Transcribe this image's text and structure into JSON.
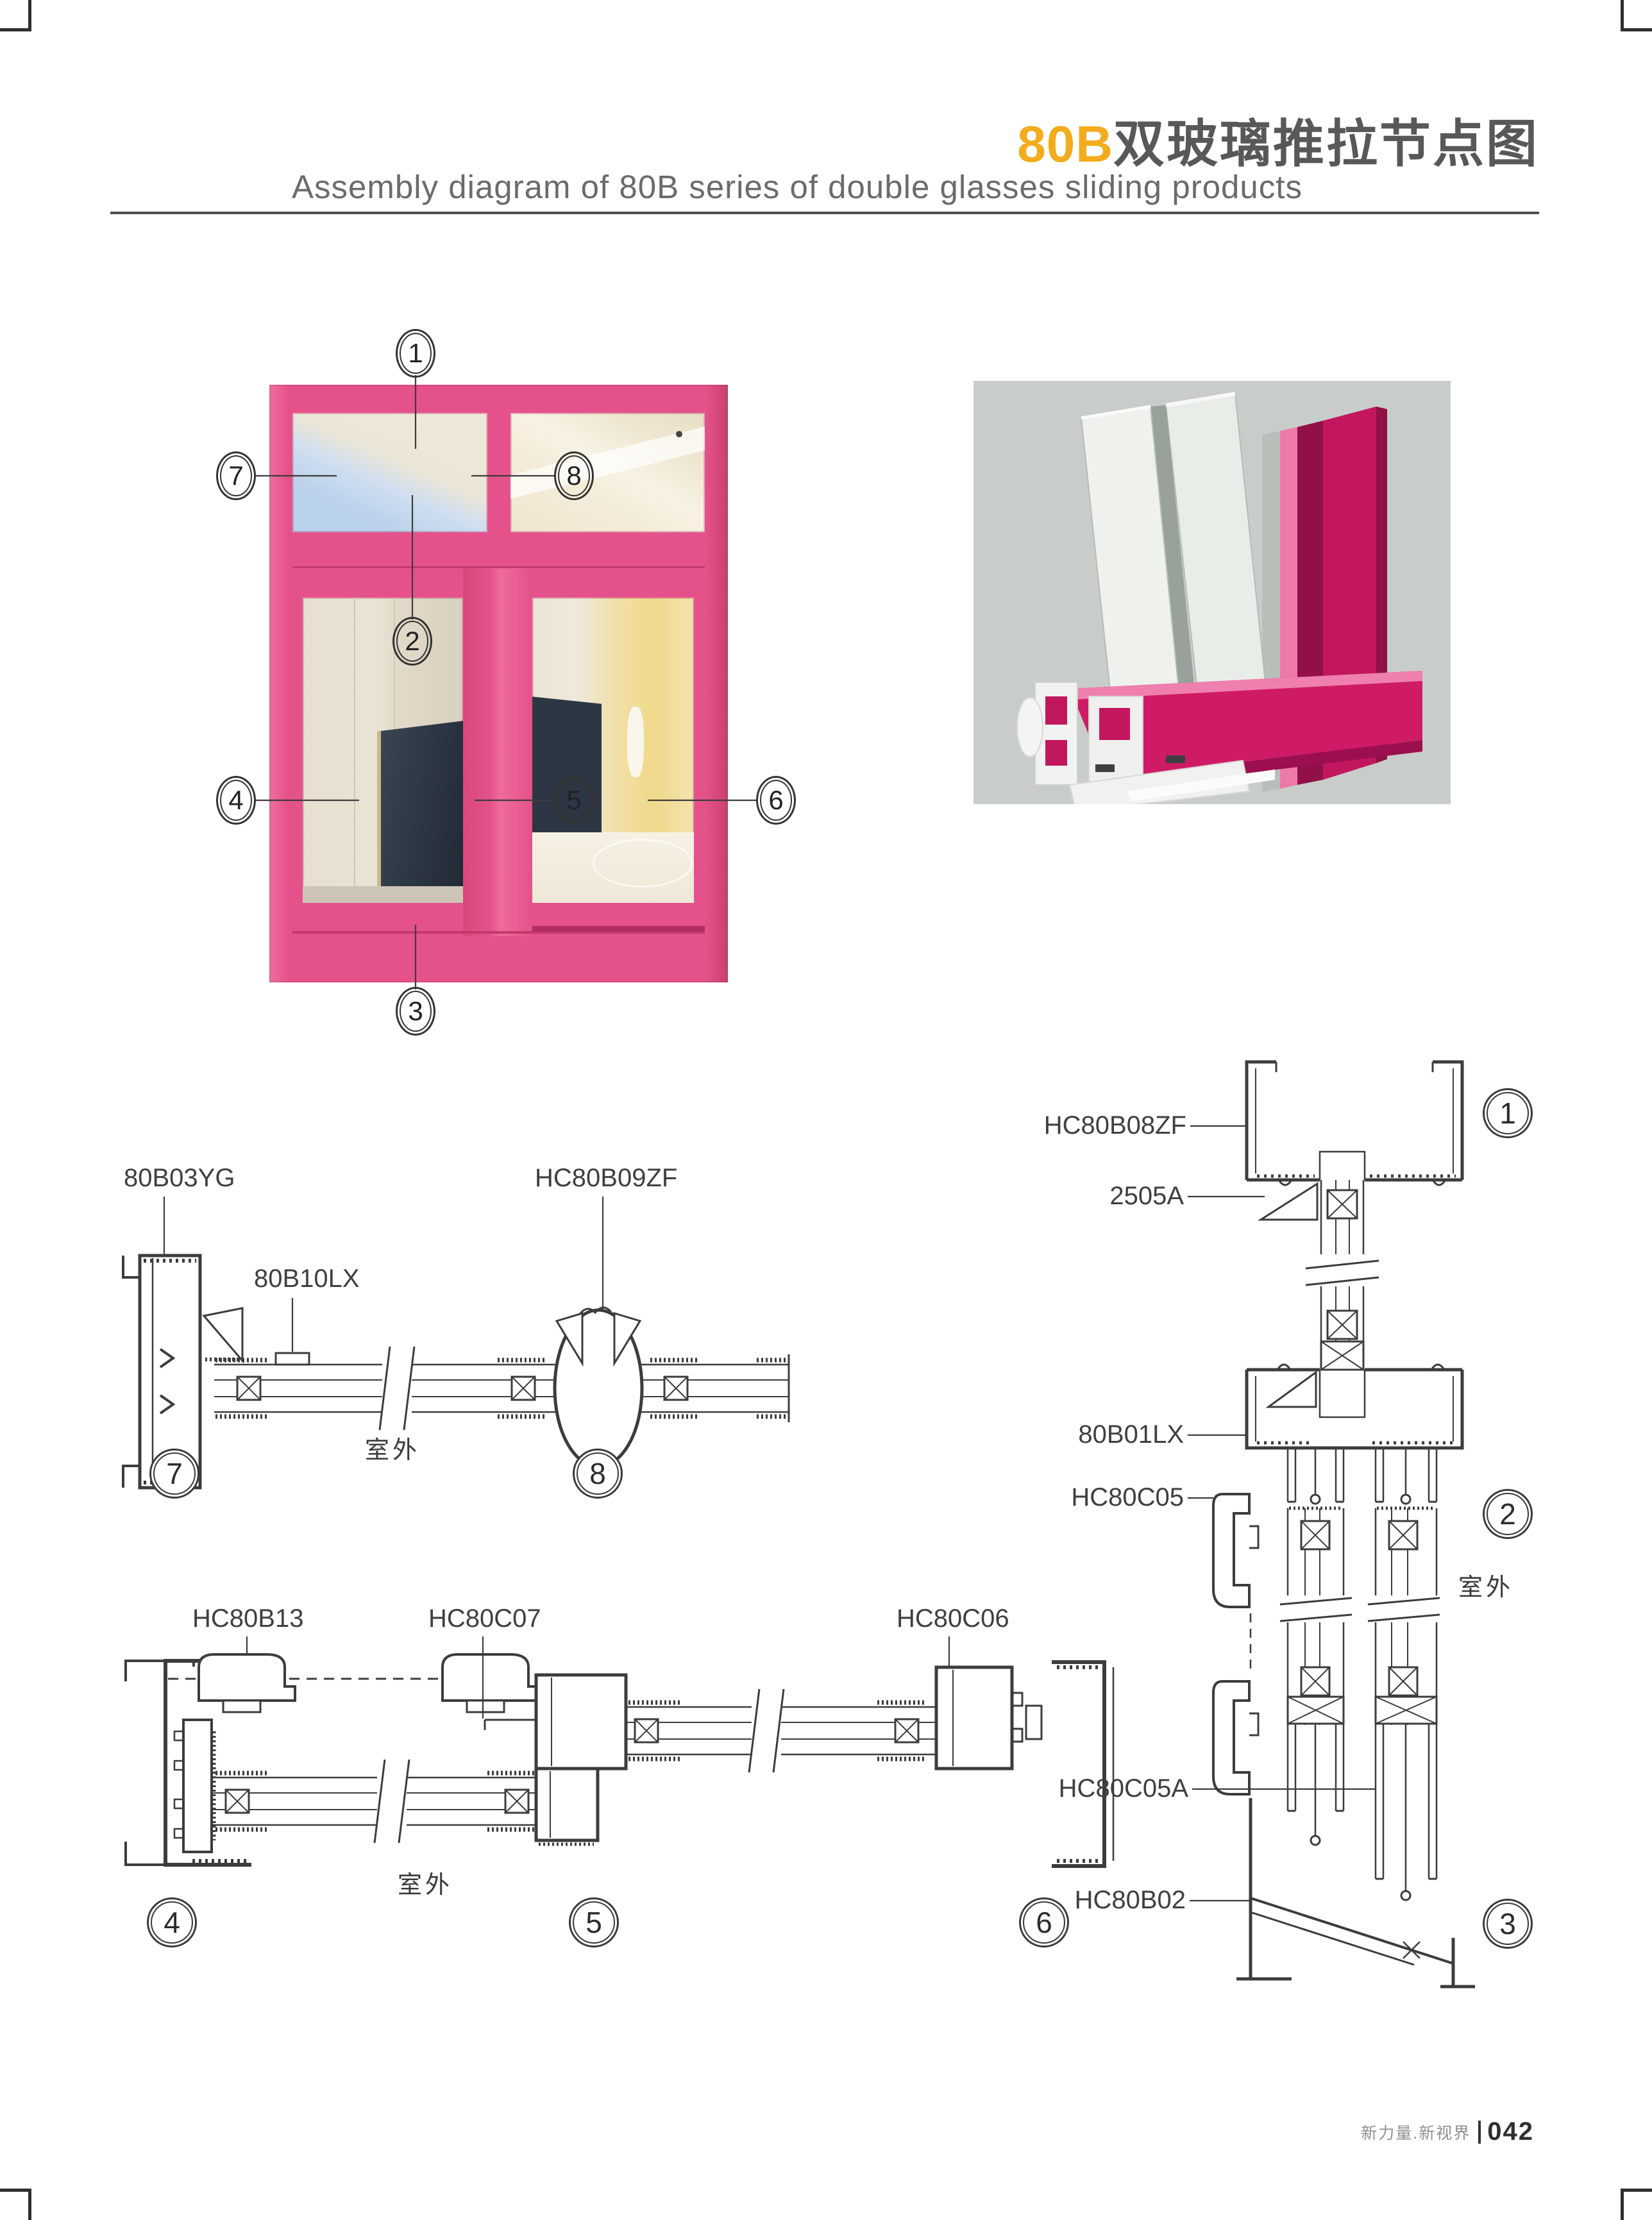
{
  "header": {
    "title_accent": "80B",
    "title_cn": "双玻璃推拉节点图",
    "subtitle": "Assembly diagram of 80B series of double glasses sliding products"
  },
  "overview": {
    "callouts": [
      "1",
      "2",
      "3",
      "4",
      "5",
      "6",
      "7",
      "8"
    ]
  },
  "sections": {
    "s78": {
      "label_80b03yg": "80B03YG",
      "label_80b10lx": "80B10LX",
      "label_hc80b09zf": "HC80B09ZF",
      "outdoor": "室外",
      "circle_7": "7",
      "circle_8": "8"
    },
    "s456": {
      "label_hc80b13": "HC80B13",
      "label_hc80c07": "HC80C07",
      "label_hc80c06": "HC80C06",
      "outdoor": "室外",
      "circle_4": "4",
      "circle_5": "5",
      "circle_6": "6"
    },
    "s123": {
      "label_hc80b08zf": "HC80B08ZF",
      "label_2505a": "2505A",
      "label_80b01lx": "80B01LX",
      "label_hc80c05": "HC80C05",
      "label_hc80c05a": "HC80C05A",
      "label_hc80b02": "HC80B02",
      "outdoor": "室外",
      "circle_1": "1",
      "circle_2": "2",
      "circle_3": "3"
    }
  },
  "footer": {
    "slogan": "新力量.新视界",
    "page_number": "042"
  },
  "colors": {
    "accent_orange": "#F2AC1D",
    "title_gray": "#58595B",
    "frame_pink": "#E5528B",
    "frame_pink_dark": "#C13B72",
    "render_bg": "#C9CDCA",
    "line": "#3C3C3C"
  }
}
